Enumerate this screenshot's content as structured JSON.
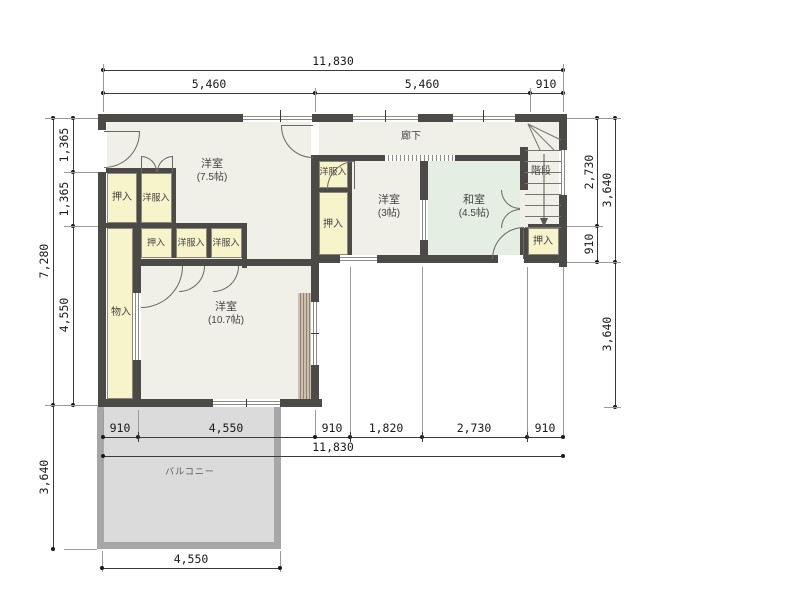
{
  "plan_type": "floor-plan",
  "colors": {
    "wall": "#4b4a46",
    "floor": "#f0efe8",
    "closet_fill": "#f7f3ca",
    "tatami_fill": "#e4eee2",
    "balcony_fill": "#dbdbdb",
    "balcony_border": "#a7a7a7",
    "dimension_text": "#1a1a1a"
  },
  "rooms": {
    "western_75": {
      "name": "洋室",
      "size": "(7.5帖)"
    },
    "western_107": {
      "name": "洋室",
      "size": "(10.7帖)"
    },
    "western_3": {
      "name": "洋室",
      "size": "(3帖)"
    },
    "japanese_45": {
      "name": "和室",
      "size": "(4.5帖)"
    },
    "corridor": {
      "name": "廊下"
    },
    "stairs": {
      "name": "階段"
    },
    "balcony": {
      "name": "バルコニー"
    },
    "storage": {
      "name": "物入"
    },
    "oshiire": {
      "name": "押入"
    },
    "closet": {
      "name": "洋服入"
    }
  },
  "dimensions": {
    "top": {
      "total": "11,830",
      "segments": [
        "5,460",
        "5,460",
        "910"
      ]
    },
    "left": {
      "segments": [
        "1,365",
        "1,365",
        "4,550"
      ],
      "total": "7,280",
      "balcony": "3,640"
    },
    "right": {
      "segments": [
        "2,730",
        "910"
      ],
      "upper": "3,640",
      "lower": "3,640"
    },
    "bottom": {
      "segments": [
        "910",
        "4,550",
        "910",
        "1,820",
        "2,730",
        "910"
      ],
      "total": "11,830",
      "balcony": "4,550"
    }
  }
}
